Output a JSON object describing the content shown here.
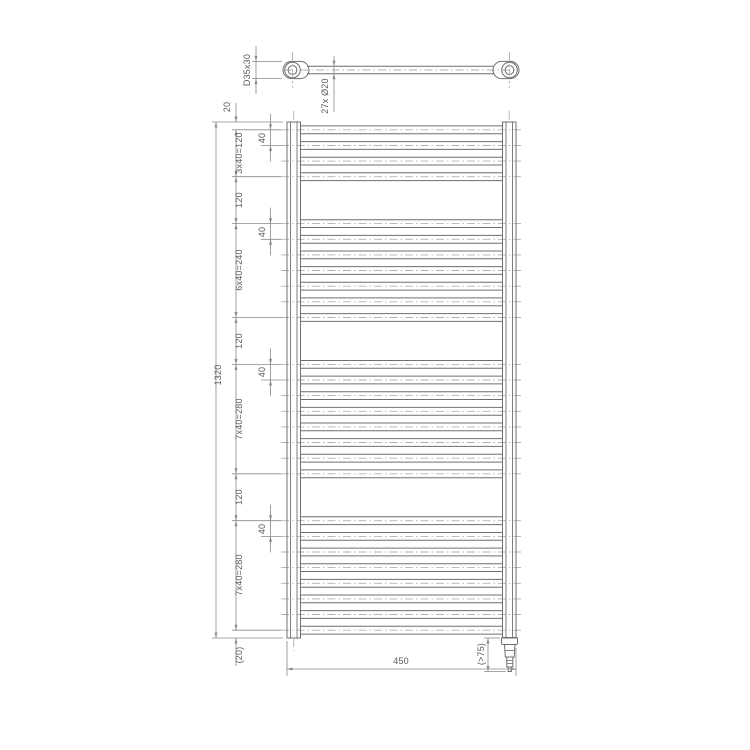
{
  "views": {
    "top_view": {
      "bracket_label": "D35x30",
      "tube_label": "27x Ø20"
    },
    "front_view": {
      "overall_height": "1320",
      "overall_width": "450",
      "element_label": "(>75)",
      "pitch_label": "40",
      "left_chain": [
        "20",
        "3x40=120",
        "120",
        "6x40=240",
        "120",
        "7x40=280",
        "120",
        "7x40=280",
        "(20)"
      ]
    }
  },
  "tube_groups": [
    {
      "count": 4,
      "start_mm": 20,
      "pitch_mm": 40
    },
    {
      "count": 7,
      "start_mm": 260,
      "pitch_mm": 40
    },
    {
      "count": 8,
      "start_mm": 620,
      "pitch_mm": 40
    },
    {
      "count": 8,
      "start_mm": 1020,
      "pitch_mm": 40
    }
  ],
  "colors": {
    "outline": "#6f6f6f",
    "dim": "#8a8a8a",
    "centerline": "#b2b2b2",
    "text": "#5a5a5a",
    "background": "#ffffff"
  }
}
